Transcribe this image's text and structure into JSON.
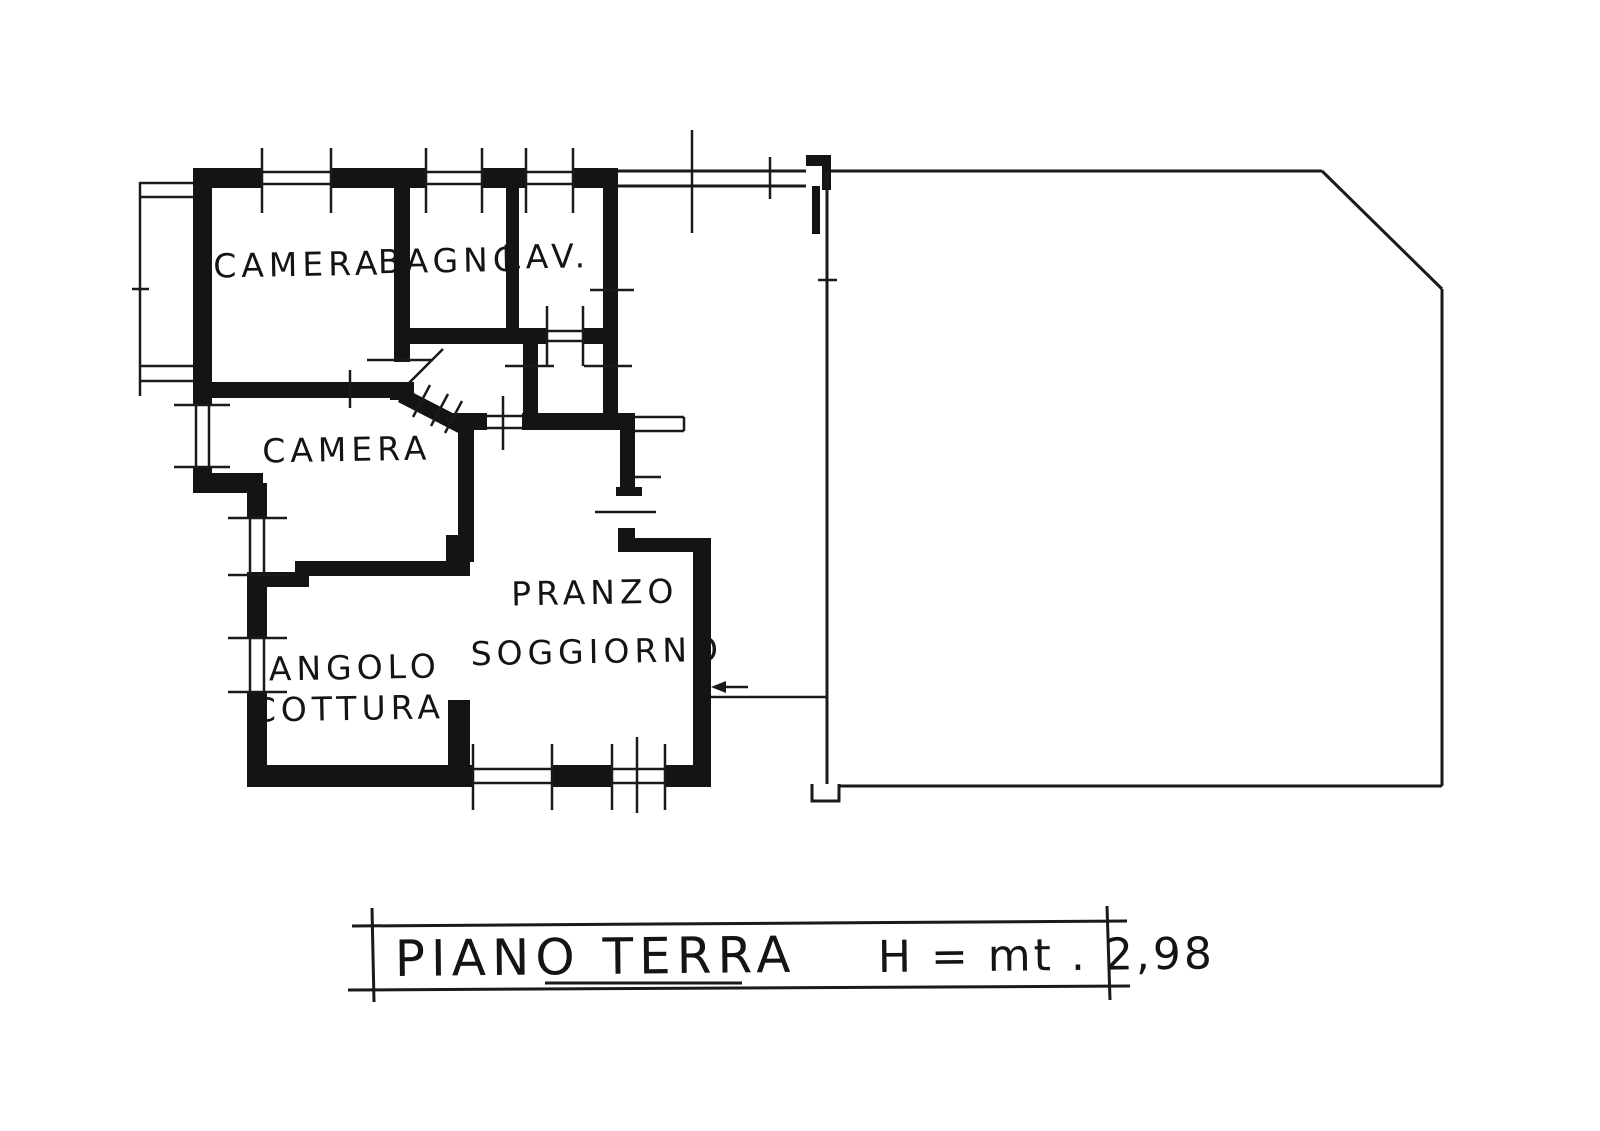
{
  "rooms": [
    {
      "id": "camera-1",
      "label": "CAMERA"
    },
    {
      "id": "bagno",
      "label": "BAGNO"
    },
    {
      "id": "lav",
      "label": "LAV."
    },
    {
      "id": "camera-2",
      "label": "CAMERA"
    },
    {
      "id": "pranzo-soggiorno",
      "label_line_1": "PRANZO",
      "label_line_2": "SOGGIORNO"
    },
    {
      "id": "angolo-cottura",
      "label_line_1": "ANGOLO",
      "label_line_2": "COTTURA"
    }
  ],
  "title_block": {
    "floor_label": "PIANO TERRA",
    "height_label": "H = mt . 2,98"
  },
  "colors": {
    "ink": "#141414",
    "paper": "#ffffff"
  }
}
